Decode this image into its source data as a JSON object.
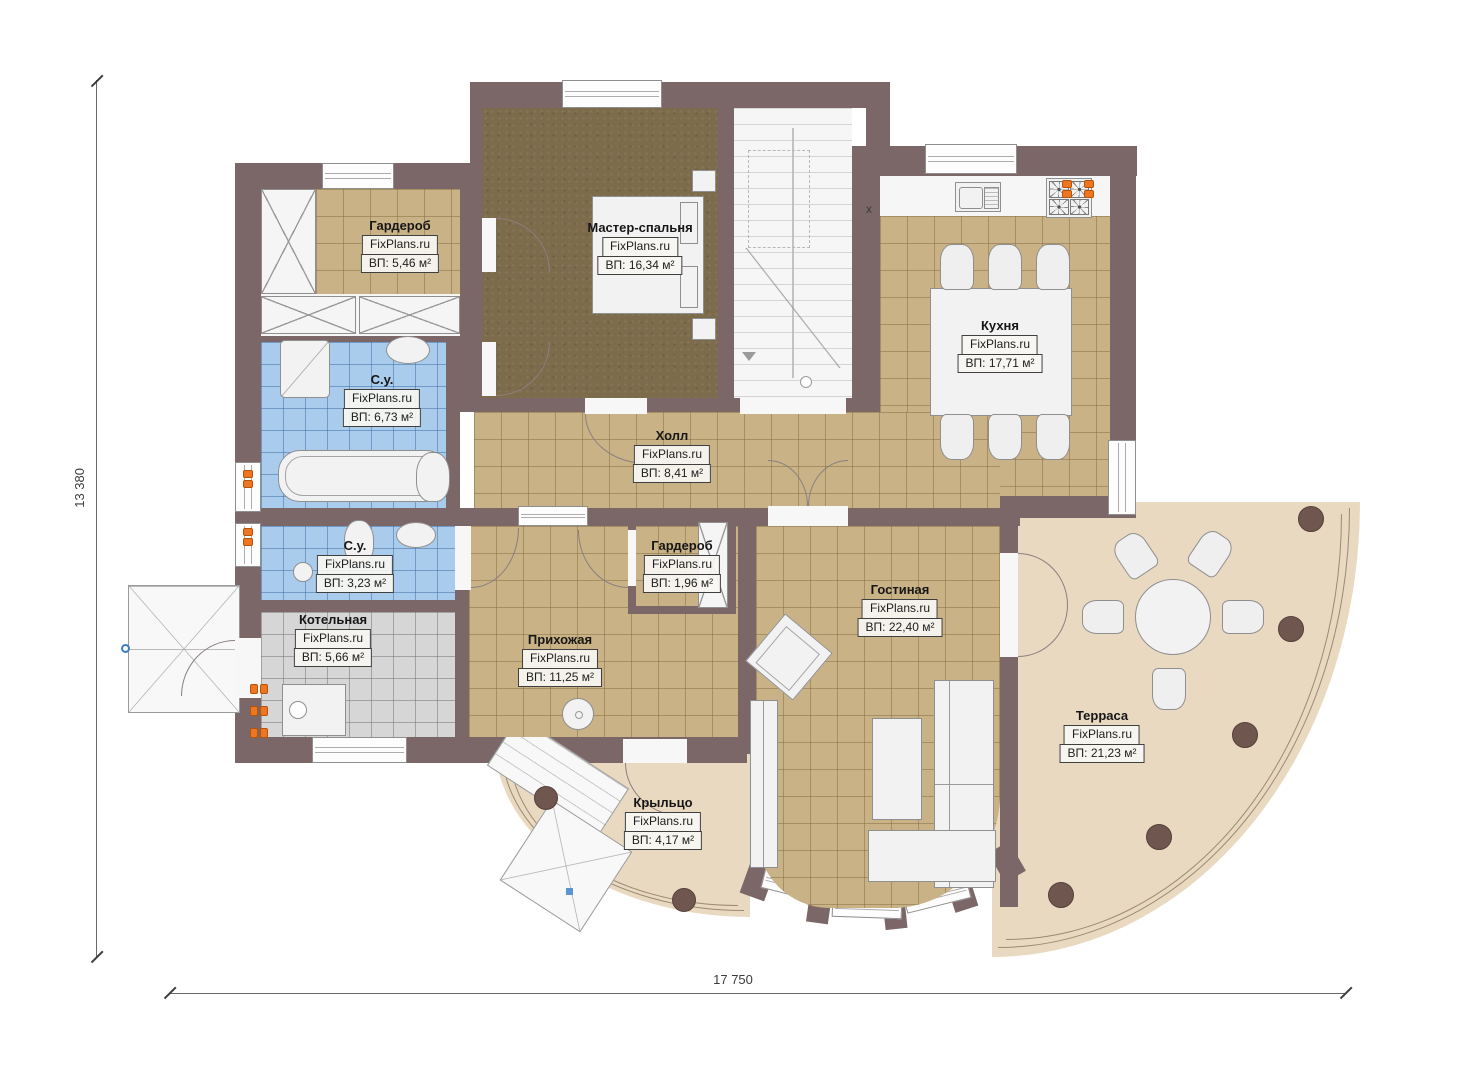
{
  "plan_title": "floor-plan",
  "brand": "FixPlans.ru",
  "dimensions": {
    "height_label": "13 380",
    "width_label": "17 750"
  },
  "marks": {
    "kitchen_x": "x"
  },
  "rooms": [
    {
      "key": "wardrobe1",
      "name": "Гардероб",
      "brand": "FixPlans.ru",
      "area": "ВП: 5,46 м²"
    },
    {
      "key": "master",
      "name": "Мастер-спальня",
      "brand": "FixPlans.ru",
      "area": "ВП: 16,34 м²"
    },
    {
      "key": "kitchen",
      "name": "Кухня",
      "brand": "FixPlans.ru",
      "area": "ВП: 17,71 м²"
    },
    {
      "key": "bath1",
      "name": "С.у.",
      "brand": "FixPlans.ru",
      "area": "ВП: 6,73 м²"
    },
    {
      "key": "hall",
      "name": "Холл",
      "brand": "FixPlans.ru",
      "area": "ВП: 8,41 м²"
    },
    {
      "key": "bath2",
      "name": "С.у.",
      "brand": "FixPlans.ru",
      "area": "ВП: 3,23 м²"
    },
    {
      "key": "wardrobe2",
      "name": "Гардероб",
      "brand": "FixPlans.ru",
      "area": "ВП: 1,96 м²"
    },
    {
      "key": "boiler",
      "name": "Котельная",
      "brand": "FixPlans.ru",
      "area": "ВП: 5,66 м²"
    },
    {
      "key": "entry",
      "name": "Прихожая",
      "brand": "FixPlans.ru",
      "area": "ВП: 11,25 м²"
    },
    {
      "key": "living",
      "name": "Гостиная",
      "brand": "FixPlans.ru",
      "area": "ВП: 22,40 м²"
    },
    {
      "key": "terrace",
      "name": "Терраса",
      "brand": "FixPlans.ru",
      "area": "ВП: 21,23 м²"
    },
    {
      "key": "porch",
      "name": "Крыльцо",
      "brand": "FixPlans.ru",
      "area": "ВП: 4,17 м²"
    }
  ],
  "colors": {
    "wall": "#7b6767",
    "tile_beige": "#c9b286",
    "tile_blue": "#a9cbec",
    "tile_gray": "#d6d6d6",
    "master_floor": "#7d6c4b",
    "outdoor": "#e9d9c0",
    "accent_orange": "#ef7620"
  }
}
